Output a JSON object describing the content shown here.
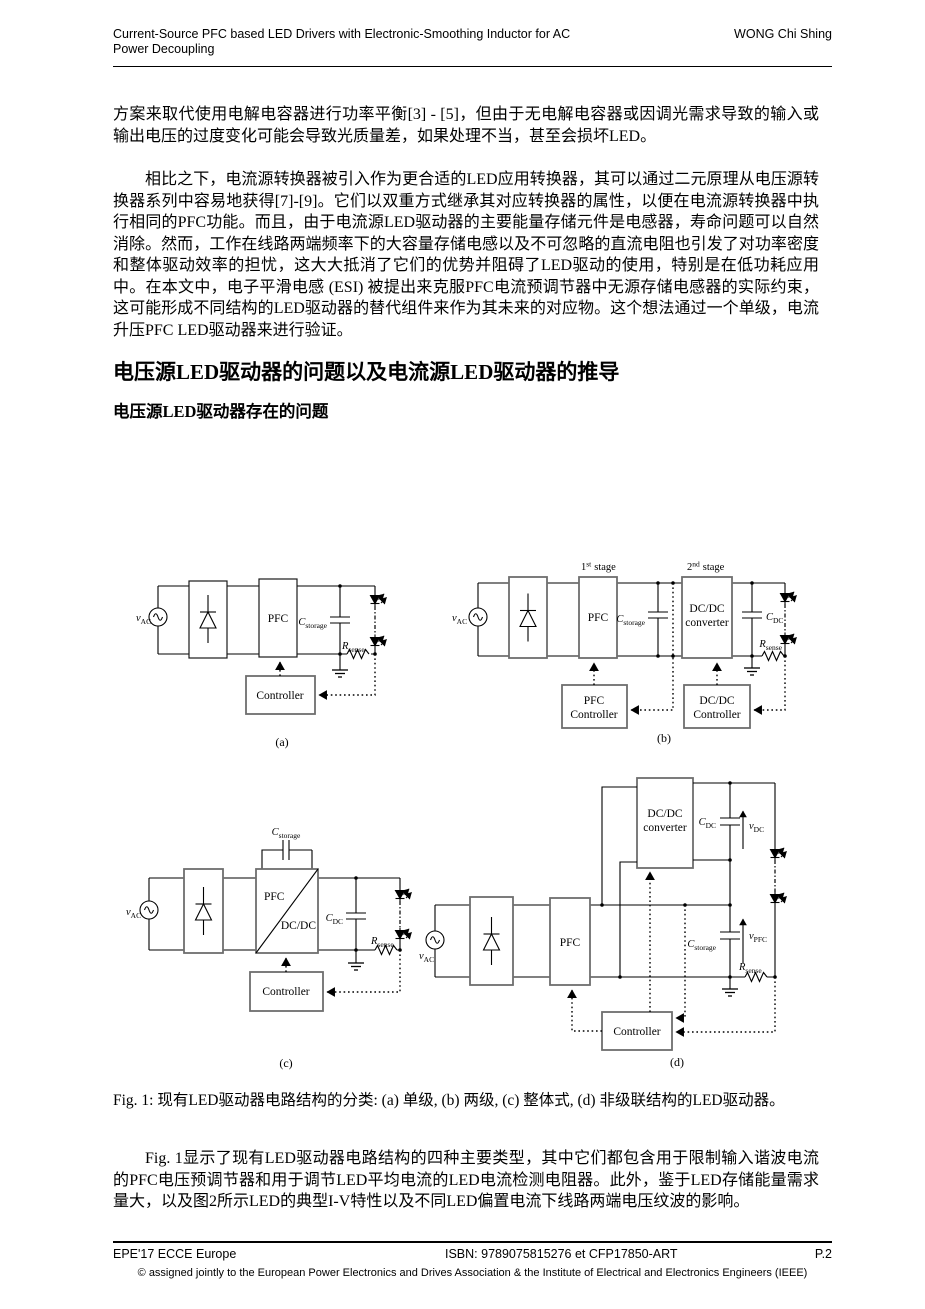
{
  "header": {
    "title_line1": "Current-Source PFC based LED Drivers with Electronic-Smoothing Inductor for AC",
    "title_line2": "Power Decoupling",
    "author": "WONG Chi Shing"
  },
  "paragraphs": {
    "p1": "方案来取代使用电解电容器进行功率平衡[3] - [5]，但由于无电解电容器或因调光需求导致的输入或输出电压的过度变化可能会导致光质量差，如果处理不当，甚至会损坏LED。",
    "p2": "相比之下，电流源转换器被引入作为更合适的LED应用转换器，其可以通过二元原理从电压源转换器系列中容易地获得[7]-[9]。它们以双重方式继承其对应转换器的属性，以便在电流源转换器中执行相同的PFC功能。而且，由于电流源LED驱动器的主要能量存储元件是电感器，寿命问题可以自然消除。然而，工作在线路两端频率下的大容量存储电感以及不可忽略的直流电阻也引发了对功率密度和整体驱动效率的担忧，这大大抵消了它们的优势并阻碍了LED驱动的使用，特别是在低功耗应用中。在本文中，电子平滑电感 (ESI) 被提出来克服PFC电流预调节器中无源存储电感器的实际约束，这可能形成不同结构的LED驱动器的替代组件来作为其未来的对应物。这个想法通过一个单级，电流升压PFC LED驱动器来进行验证。",
    "p3": "Fig. 1显示了现有LED驱动器电路结构的四种主要类型，其中它们都包含用于限制输入谐波电流的PFC电压预调节器和用于调节LED平均电流的LED电流检测电阻器。此外，鉴于LED存储能量需求量大，以及图2所示LED的典型I-V特性以及不同LED偏置电流下线路两端电压纹波的影响。"
  },
  "headings": {
    "h1": "电压源LED驱动器的问题以及电流源LED驱动器的推导",
    "h2": "电压源LED驱动器存在的问题"
  },
  "figure": {
    "caption": "Fig. 1:  现有LED驱动器电路结构的分类: (a) 单级, (b) 两级, (c) 整体式, (d) 非级联结构的LED驱动器。",
    "labels": {
      "sym_v": "v",
      "sym_C": "C",
      "sym_R": "R",
      "sub_AC": "AC",
      "sub_storage": "storage",
      "sub_DC": "DC",
      "sub_sense": "sense",
      "sub_PFC": "PFC",
      "pfc": "PFC",
      "dcdc": "DC/DC",
      "converter": "converter",
      "controller": "Controller",
      "num_1": "1",
      "sup_st": "st",
      "num_2": "2",
      "sup_nd": "nd",
      "stage": "stage",
      "tag_a": "(a)",
      "tag_b": "(b)",
      "tag_c": "(c)",
      "tag_d": "(d)"
    }
  },
  "footer": {
    "left": "EPE'17 ECCE Europe",
    "center": "ISBN: 9789075815276 et CFP17850-ART",
    "right": "P.2",
    "copyright": "© assigned jointly to the European Power Electronics and Drives Association & the Institute of Electrical and Electronics Engineers (IEEE)"
  }
}
